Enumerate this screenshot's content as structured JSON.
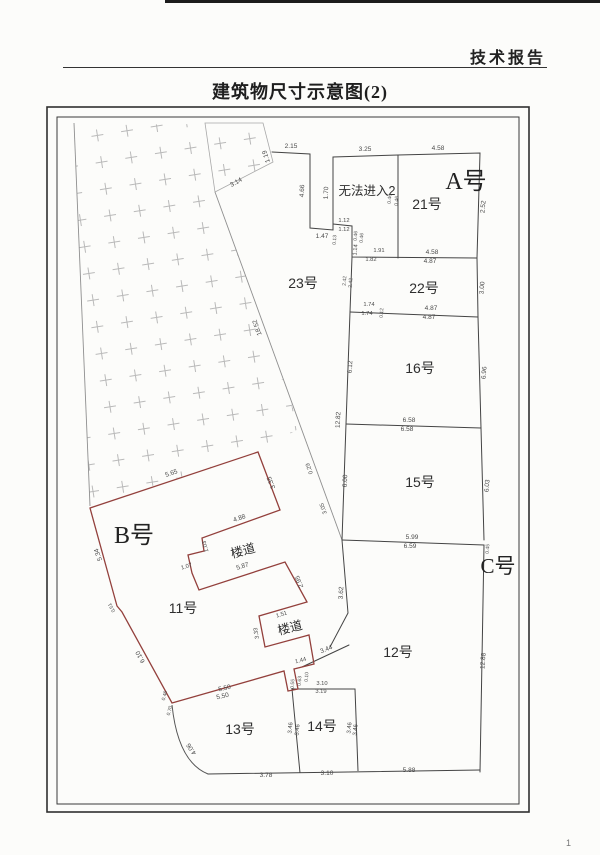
{
  "page": {
    "header": "技术报告",
    "title": "建筑物尺寸示意图(2)",
    "page_number": "1"
  },
  "diagram": {
    "buildings": {
      "a": "A号",
      "b": "B号",
      "c": "C号"
    },
    "rooms": {
      "r23": "23号",
      "r21": "21号",
      "r22": "22号",
      "r16": "16号",
      "r15": "15号",
      "r12": "12号",
      "r11": "11号",
      "r13": "13号",
      "r14": "14号",
      "no_entry": "无法进入2",
      "corridor1": "楼道",
      "corridor2": "楼道"
    },
    "dims": {
      "d01": "2.15",
      "d02": "4.66",
      "d03": "1.47",
      "d04": "1.70",
      "d05": "3.25",
      "d06": "4.58",
      "d07": "2.52",
      "d08": "0.46",
      "d09": "0.46",
      "d10": "1.12",
      "d11": "1.12",
      "d12": "0.13",
      "d13": "0.46",
      "d14": "0.46",
      "d15": "1.14",
      "d16": "1.91",
      "d17": "1.82",
      "d18": "4.58",
      "d19": "4.87",
      "d20": "3.00",
      "d21": "2.42",
      "d22": "2.42",
      "d23": "1.74",
      "d24": "1.74",
      "d25": "0.12",
      "d26": "4.87",
      "d27": "4.87",
      "d28": "6.12",
      "d29": "6.96",
      "d30": "6.58",
      "d31": "6.58",
      "d32": "12.82",
      "d33": "6.00",
      "d34": "6.03",
      "d35": "5.99",
      "d36": "6.59",
      "d37": "0.45",
      "d38": "12.88",
      "d39": "3.62",
      "d40": "18.52",
      "d41": "0.29",
      "d42": "3.05",
      "d43": "5.65",
      "d44": "3.35",
      "d45": "4.88",
      "d46": "1.03",
      "d47": "1.07",
      "d48": "5.87",
      "d49": "2.95",
      "d50": "1.51",
      "d51": "3.33",
      "d52": "1.44",
      "d53": "0.10",
      "d54": "0.63",
      "d55": "0.55",
      "d56": "5.50",
      "d57": "5.50",
      "d58": "0.46",
      "d59": "0.70",
      "d60": "6.10",
      "d61": "0.51",
      "d62": "5.34",
      "d63": "3.44",
      "d64": "4.06",
      "d65": "3.78",
      "d66": "3.10",
      "d67": "5.88",
      "d68": "3.10",
      "d69": "3.19",
      "d70": "3.46",
      "d71": "3.46",
      "d72": "3.46",
      "d73": "3.46",
      "d74": "3.14",
      "d75": "1.19"
    }
  }
}
